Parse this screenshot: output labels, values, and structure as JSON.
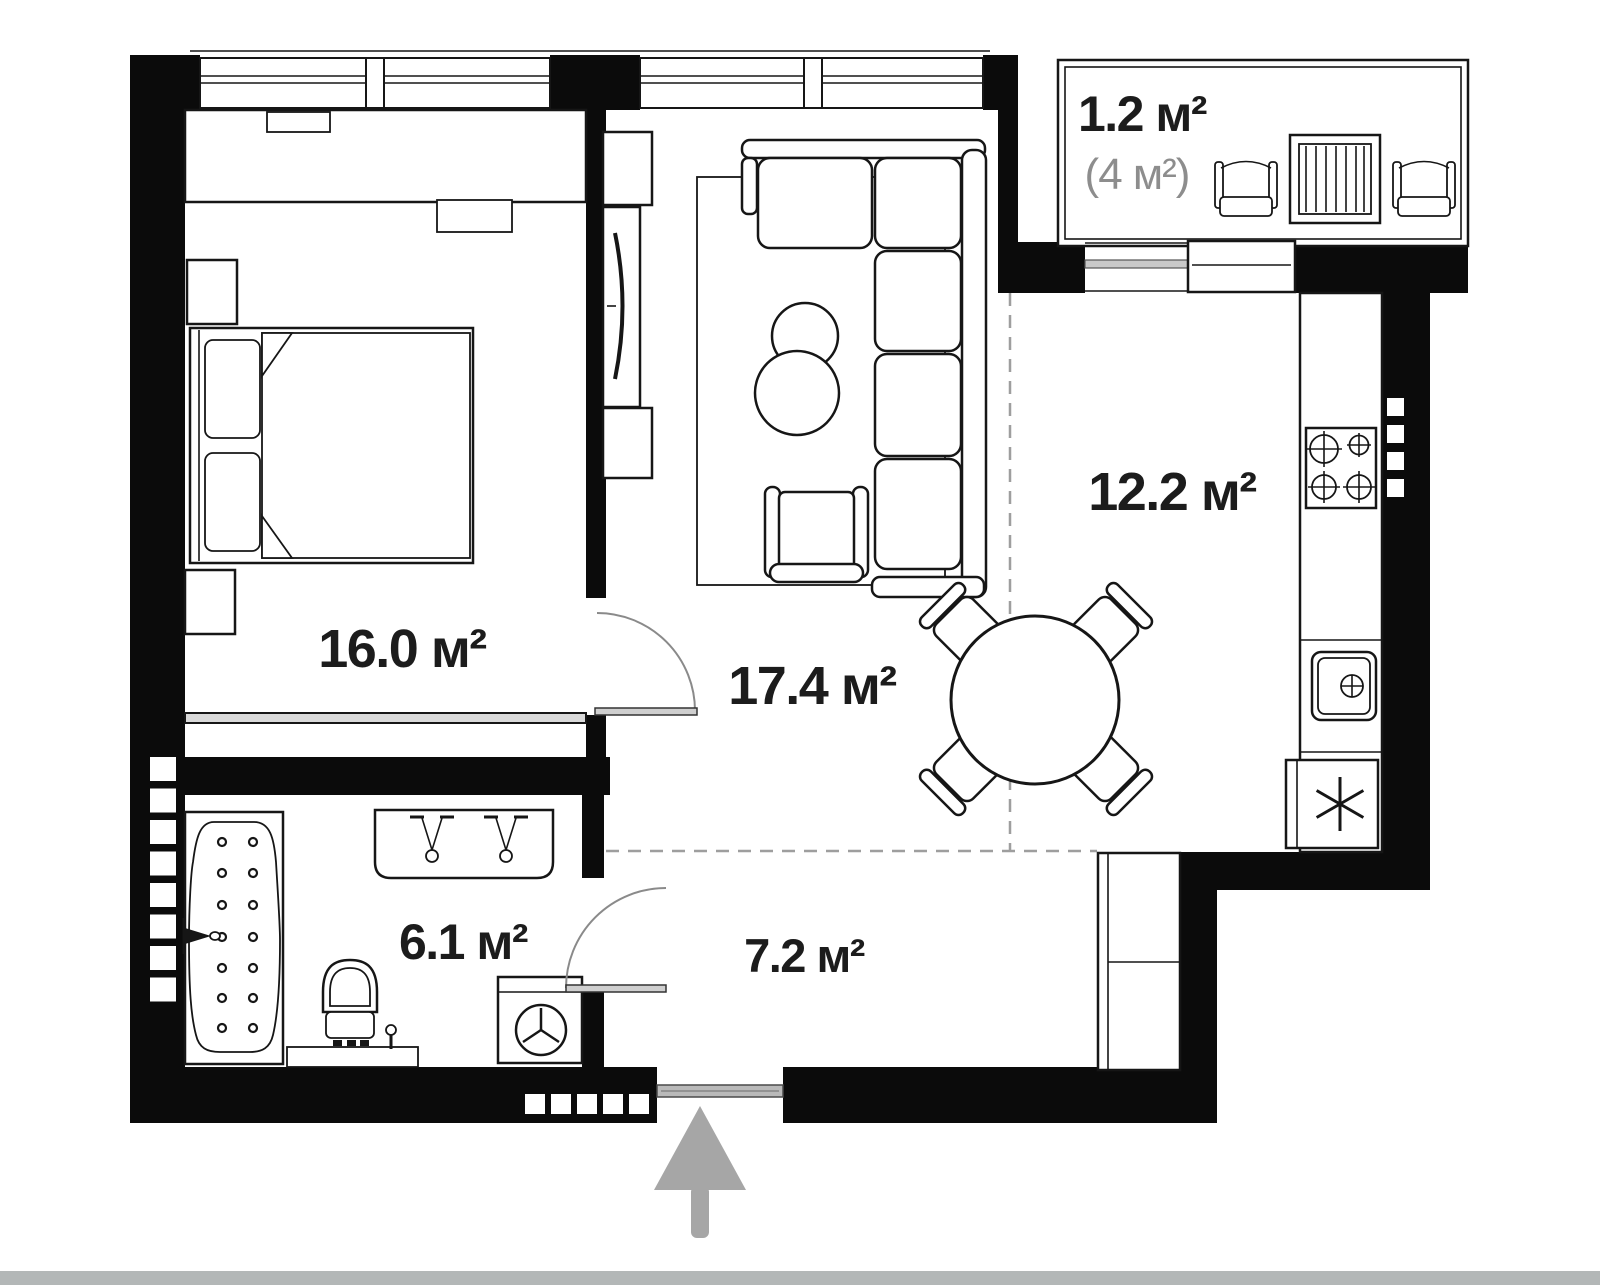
{
  "rooms": {
    "bedroom": {
      "area": "16.0 м²"
    },
    "living": {
      "area": "17.4 м²"
    },
    "kitchen": {
      "area": "12.2 м²"
    },
    "bathroom": {
      "area": "6.1 м²"
    },
    "hallway": {
      "area": "7.2 м²"
    },
    "balcony": {
      "area": "1.2 м²",
      "area_total": "(4 м²)"
    }
  },
  "entrance": {
    "arrow": "up-arrow"
  },
  "fixtures": {
    "bedroom": [
      "wardrobe",
      "double-bed",
      "pillow",
      "pillow",
      "nightstand",
      "nightstand"
    ],
    "living": [
      "tv-stand",
      "tv",
      "rug",
      "corner-sofa",
      "coffee-table",
      "coffee-table",
      "armchair"
    ],
    "kitchen": [
      "counter",
      "stove-4-burner",
      "sink",
      "fridge",
      "dining-table",
      "chair",
      "chair",
      "chair",
      "chair"
    ],
    "bathroom": [
      "bathtub",
      "bath-faucet",
      "double-sink-vanity",
      "toilet",
      "toilet-brush",
      "washing-machine"
    ],
    "hallway": [
      "wardrobe",
      "entrance-door"
    ],
    "balcony": [
      "chair",
      "table",
      "chair"
    ]
  },
  "colors": {
    "background": "#ffffff",
    "wall": "#0b0b0b",
    "line": "#161616",
    "label": "#1c1c1c",
    "label_secondary": "#8d8d8d",
    "door_arc": "#8a8a8a",
    "door_leaf": "#cfcfcf",
    "threshold": "#b9b9b9",
    "zone_dash": "#9e9e9e",
    "arrow": "#a6a6a6",
    "footer_bar": "#b3b7b7"
  }
}
